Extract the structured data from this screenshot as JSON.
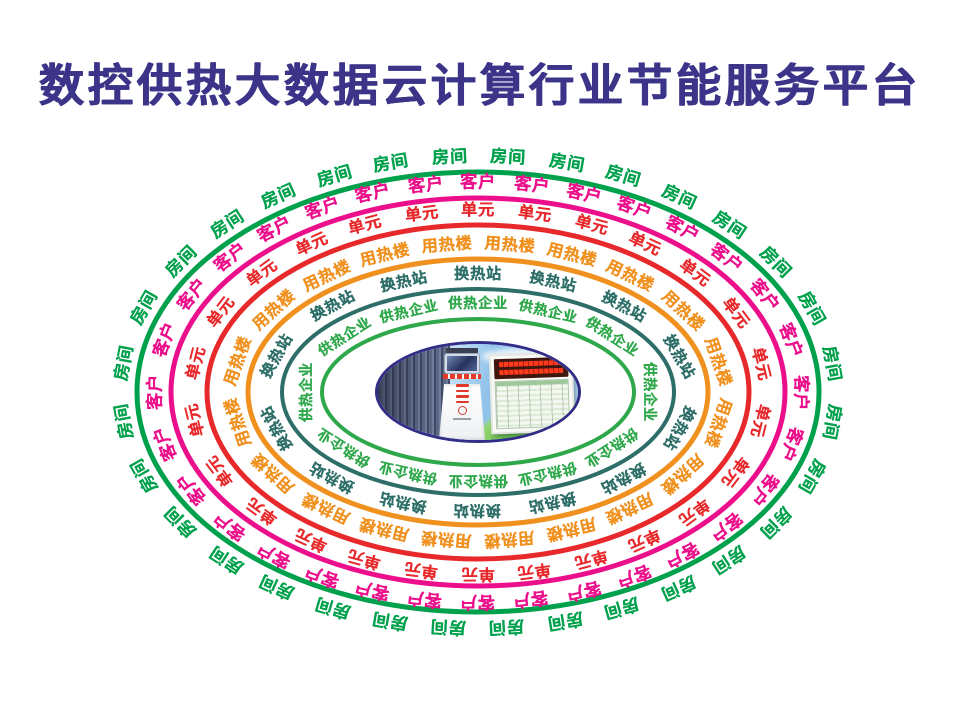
{
  "title": "数控供热大数据云计算行业节能服务平台",
  "title_color": "#3b3489",
  "diagram": {
    "description": "concentric elliptical rings of repeated labels around a central photo",
    "rings": [
      {
        "name": "room",
        "label": "房间",
        "color": "#00a14d",
        "count": 32
      },
      {
        "name": "customer",
        "label": "客户",
        "color": "#ec0f8b",
        "count": 32
      },
      {
        "name": "unit",
        "label": "单元",
        "color": "#e8292c",
        "count": 26
      },
      {
        "name": "heating-building",
        "label": "用热楼",
        "color": "#f0911f",
        "count": 20
      },
      {
        "name": "heat-exchange-station",
        "label": "换热站",
        "color": "#2e6e68",
        "count": 14
      },
      {
        "name": "heating-enterprise",
        "label": "供热企业",
        "color": "#2fa84c",
        "count": 12
      }
    ],
    "center_image": {
      "alt": "heating-monitoring-kiosk-and-data-screen-photo",
      "border_color": "#322d86"
    }
  }
}
